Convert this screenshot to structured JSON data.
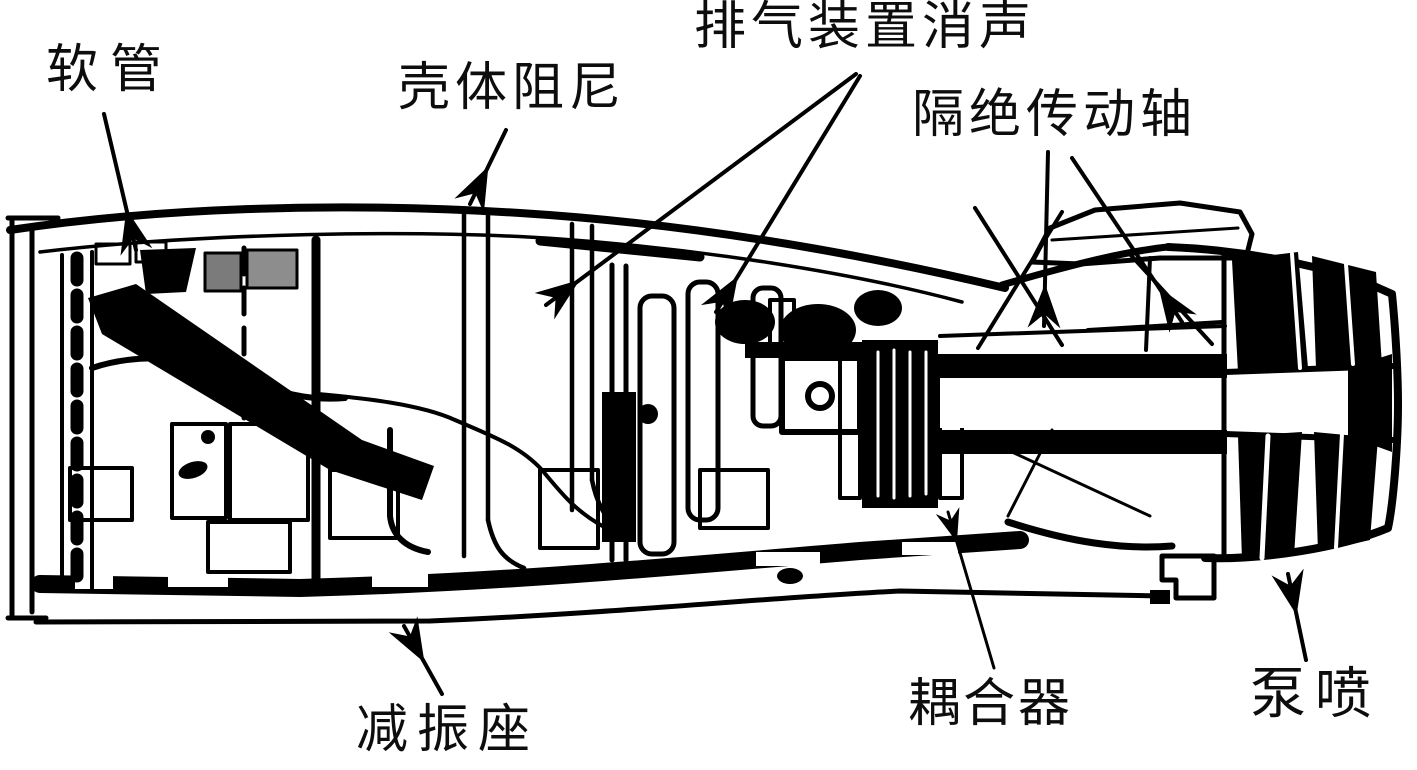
{
  "figure": {
    "kind": "technical cutaway line diagram",
    "subject": "torpedo propulsion-section noise-reduction cutaway",
    "background_color": "#ffffff",
    "ink_color": "#000000"
  },
  "annotations": {
    "hose": {
      "label": "软管",
      "arrows": 1
    },
    "shell_damping": {
      "label": "壳体阻尼",
      "arrows": 1
    },
    "exhaust_silencer": {
      "label": "排气装置消声",
      "arrows": 2
    },
    "isolated_shaft": {
      "label": "隔绝传动轴",
      "arrows": 2
    },
    "vibration_mount": {
      "label": "减振座",
      "arrows": 1
    },
    "coupler": {
      "label": "耦合器",
      "arrows": 1
    },
    "pump_jet": {
      "label": "泵喷",
      "arrows": 1
    }
  }
}
